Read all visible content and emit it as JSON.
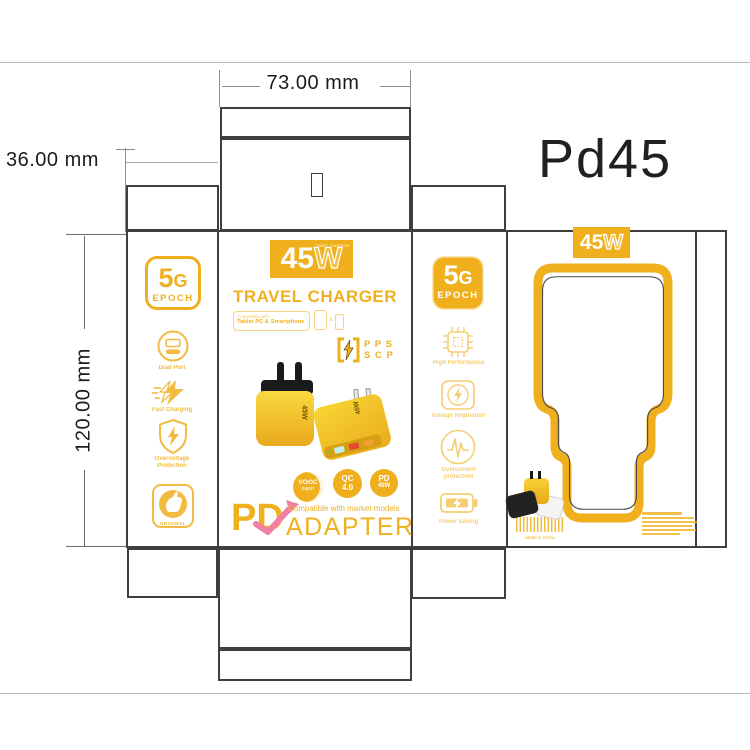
{
  "annotations": {
    "width_label": "73.00 mm",
    "flap_label": "36.00 mm",
    "height_label": "120.00 mm",
    "model_label": "Pd45"
  },
  "colors": {
    "yellow": "#F0B01E",
    "pink": "#EF7FA6",
    "dieline": "#3F3F3F"
  },
  "left_panel": {
    "badge_5": "5",
    "badge_g": "G",
    "badge_epoch": "EPOCH",
    "features": [
      {
        "icon": "dual-port-icon",
        "label": "Dual Port"
      },
      {
        "icon": "fast-charging-icon",
        "label": "Fast Charging"
      },
      {
        "icon": "overvoltage-shield-icon",
        "label_line1": "Overvoltage",
        "label_line2": "Protection"
      },
      {
        "icon": "original-thumb-icon",
        "label": "ORIGINAL"
      }
    ]
  },
  "front_panel": {
    "power_badge_45": "45",
    "power_badge_w": "W",
    "power_badge_sub": "FAST CHARGE",
    "title": "TRAVEL CHARGER",
    "compatible_line1": "Compatible with",
    "compatible_line2": "Tablet PC & Smartphone",
    "ampersand": "&",
    "pps": "P P S",
    "scp": "S C P",
    "charger_side_label": "45W",
    "charger_top_label": "45W",
    "badges": [
      {
        "line1": "VOOC",
        "line2": "super"
      },
      {
        "line1": "QC",
        "line2": "4.0"
      },
      {
        "line1": "PD",
        "line2": "45W"
      }
    ],
    "pd": "PD",
    "compatible_market": "Compatible with market models",
    "adapter": "ADAPTER"
  },
  "side_panel": {
    "badge_5": "5",
    "badge_g": "G",
    "badge_epoch": "EPOCH",
    "features": [
      {
        "icon": "chip-icon",
        "label": "High Performance"
      },
      {
        "icon": "voltage-regulation-icon",
        "label": "Voltage Regulation"
      },
      {
        "icon": "overcurrent-wave-icon",
        "label_line1": "Overcurrent",
        "label_line2": "protection"
      },
      {
        "icon": "power-saving-battery-icon",
        "label": "Power Saving"
      }
    ]
  },
  "back_panel": {
    "power_badge_45": "45",
    "power_badge_w": "W",
    "made_in": "Made in China"
  }
}
